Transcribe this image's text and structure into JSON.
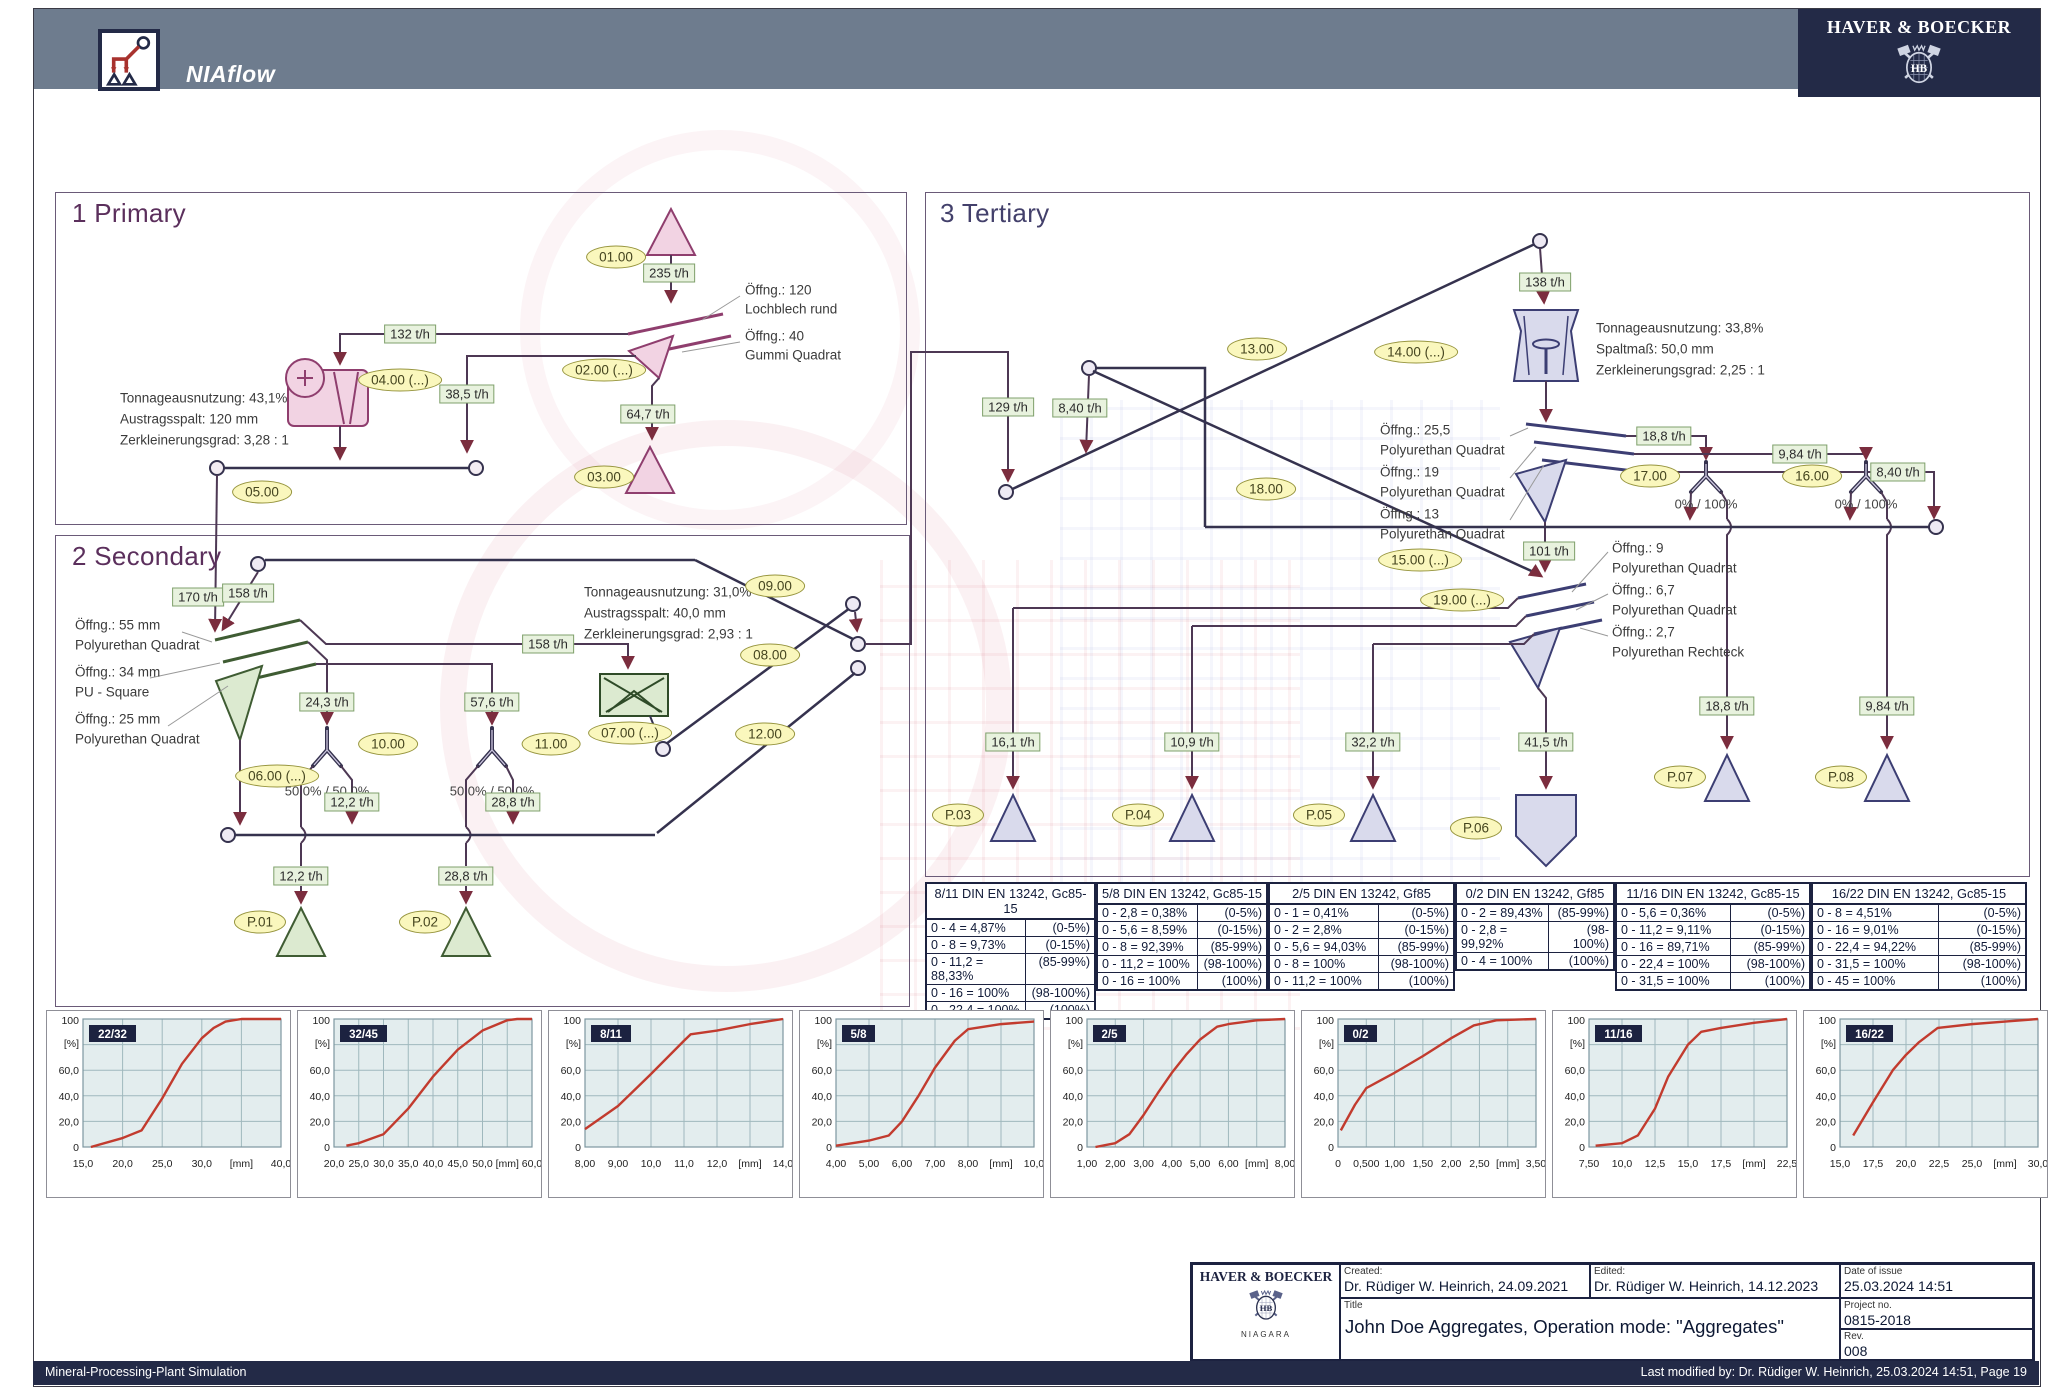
{
  "header": {
    "app_name": "NIAflow",
    "brand": "HAVER & BOECKER"
  },
  "footer": {
    "left": "Mineral-Processing-Plant Simulation",
    "right": "Last modified by: Dr. Rüdiger W. Heinrich, 25.03.2024 14:51, Page 19"
  },
  "title_block": {
    "brand": "HAVER & BOECKER",
    "brand_sub": "NIAGARA",
    "created_label": "Created:",
    "created": "Dr. Rüdiger W. Heinrich, 24.09.2021",
    "edited_label": "Edited:",
    "edited": "Dr. Rüdiger W. Heinrich, 14.12.2023",
    "date_label": "Date of issue",
    "date": "25.03.2024 14:51",
    "title_label": "Title",
    "title": "John Doe Aggregates, Operation mode: \"Aggregates\"",
    "project_label": "Project no.",
    "project": "0815-2018",
    "rev_label": "Rev.",
    "rev": "008"
  },
  "flowsheet": {
    "primary": {
      "title": "1 Primary",
      "nodes": {
        "n01": "01.00",
        "n02": "02.00 (...)",
        "n03": "03.00",
        "n04": "04.00 (...)",
        "n05": "05.00"
      },
      "flows": {
        "f235": "235 t/h",
        "f132": "132 t/h",
        "f385": "38,5 t/h",
        "f647": "64,7 t/h"
      },
      "screen_anno": [
        "Öffng.: 120",
        "Lochblech rund",
        "Öffng.: 40",
        "Gummi Quadrat"
      ],
      "crusher_anno": [
        "Tonnageausnutzung: 43,1%",
        "Austragsspalt: 120 mm",
        "Zerkleinerungsgrad: 3,28 : 1"
      ]
    },
    "secondary": {
      "title": "2 Secondary",
      "nodes": {
        "n06": "06.00 (...)",
        "n07": "07.00 (...)",
        "n08": "08.00",
        "n09": "09.00",
        "n10": "10.00",
        "n11": "11.00",
        "n12": "12.00",
        "p01": "P.01",
        "p02": "P.02"
      },
      "flows": {
        "f170": "170 t/h",
        "f158a": "158 t/h",
        "f158b": "158 t/h",
        "f243": "24,3 t/h",
        "f576": "57,6 t/h",
        "f122a": "12,2 t/h",
        "f288a": "28,8 t/h",
        "f122b": "12,2 t/h",
        "f288b": "28,8 t/h"
      },
      "screen_anno": [
        "Öffng.: 55 mm",
        "Polyurethan Quadrat",
        "Öffng.: 34 mm",
        "PU - Square",
        "Öffng.: 25 mm",
        "Polyurethan Quadrat"
      ],
      "crusher_anno": [
        "Tonnageausnutzung: 31,0%",
        "Austragsspalt: 40,0 mm",
        "Zerkleinerungsgrad: 2,93 : 1"
      ],
      "split10": "50,0% / 50,0%",
      "split11": "50,0% / 50,0%"
    },
    "tertiary": {
      "title": "3 Tertiary",
      "nodes": {
        "n13": "13.00",
        "n14": "14.00 (...)",
        "n15": "15.00 (...)",
        "n16": "16.00",
        "n17": "17.00",
        "n18": "18.00",
        "n19": "19.00 (...)",
        "p03": "P.03",
        "p04": "P.04",
        "p05": "P.05",
        "p06": "P.06",
        "p07": "P.07",
        "p08": "P.08"
      },
      "flows": {
        "f129": "129 t/h",
        "f840a": "8,40 t/h",
        "f138": "138 t/h",
        "f101": "101 t/h",
        "f188a": "18,8 t/h",
        "f984a": "9,84 t/h",
        "f840b": "8,40 t/h",
        "f161": "16,1 t/h",
        "f109": "10,9 t/h",
        "f322": "32,2 t/h",
        "f415": "41,5 t/h",
        "f188b": "18,8 t/h",
        "f984b": "9,84 t/h"
      },
      "crusher_anno": [
        "Tonnageausnutzung: 33,8%",
        "Spaltmaß: 50,0 mm",
        "Zerkleinerungsgrad: 2,25 : 1"
      ],
      "screen15_anno": [
        "Öffng.: 25,5",
        "Polyurethan Quadrat",
        "Öffng.: 19",
        "Polyurethan Quadrat",
        "Öffng.: 13",
        "Polyurethan Quadrat"
      ],
      "screen19_anno": [
        "Öffng.: 9",
        "Polyurethan Quadrat",
        "Öffng.: 6,7",
        "Polyurethan Quadrat",
        "Öffng.: 2,7",
        "Polyurethan Rechteck"
      ],
      "split17": "0% / 100%",
      "split16": "0% / 100%"
    }
  },
  "tables": [
    {
      "header": "8/11 DIN EN 13242, Gc85-15",
      "rows": [
        [
          "0 - 4 = 4,87%",
          "(0-5%)"
        ],
        [
          "0 - 8 = 9,73%",
          "(0-15%)"
        ],
        [
          "0 - 11,2 = 88,33%",
          "(85-99%)"
        ],
        [
          "0 - 16 = 100%",
          "(98-100%)"
        ],
        [
          "0 - 22,4 = 100%",
          "(100%)"
        ]
      ]
    },
    {
      "header": "5/8 DIN EN 13242, Gc85-15",
      "rows": [
        [
          "0 - 2,8 = 0,38%",
          "(0-5%)"
        ],
        [
          "0 - 5,6 = 8,59%",
          "(0-15%)"
        ],
        [
          "0 - 8 = 92,39%",
          "(85-99%)"
        ],
        [
          "0 - 11,2 = 100%",
          "(98-100%)"
        ],
        [
          "0 - 16 = 100%",
          "(100%)"
        ]
      ]
    },
    {
      "header": "2/5 DIN EN 13242, Gf85",
      "rows": [
        [
          "0 - 1 = 0,41%",
          "(0-5%)"
        ],
        [
          "0 - 2 = 2,8%",
          "(0-15%)"
        ],
        [
          "0 - 5,6 = 94,03%",
          "(85-99%)"
        ],
        [
          "0 - 8 = 100%",
          "(98-100%)"
        ],
        [
          "0 - 11,2 = 100%",
          "(100%)"
        ]
      ]
    },
    {
      "header": "0/2 DIN EN 13242, Gf85",
      "rows": [
        [
          "0 - 2 = 89,43%",
          "(85-99%)"
        ],
        [
          "0 - 2,8 = 99,92%",
          "(98-100%)"
        ],
        [
          "0 - 4 = 100%",
          "(100%)"
        ]
      ]
    },
    {
      "header": "11/16 DIN EN 13242, Gc85-15",
      "rows": [
        [
          "0 - 5,6 = 0,36%",
          "(0-5%)"
        ],
        [
          "0 - 11,2 = 9,11%",
          "(0-15%)"
        ],
        [
          "0 - 16 = 89,71%",
          "(85-99%)"
        ],
        [
          "0 - 22,4 = 100%",
          "(98-100%)"
        ],
        [
          "0 - 31,5 = 100%",
          "(100%)"
        ]
      ]
    },
    {
      "header": "16/22 DIN EN 13242, Gc85-15",
      "rows": [
        [
          "0 - 8 = 4,51%",
          "(0-5%)"
        ],
        [
          "0 - 16 = 9,01%",
          "(0-15%)"
        ],
        [
          "0 - 22,4 = 94,22%",
          "(85-99%)"
        ],
        [
          "0 - 31,5 = 100%",
          "(98-100%)"
        ],
        [
          "0 - 45 = 100%",
          "(100%)"
        ]
      ]
    }
  ],
  "chart_data": [
    {
      "type": "line",
      "name": "22/32",
      "yunit": "[%]",
      "ylim": [
        0,
        100
      ],
      "yticks": [
        "100",
        "60,0",
        "40,0",
        "20,0",
        "0"
      ],
      "xtick_pos": [
        15,
        20,
        25,
        30,
        35,
        40
      ],
      "xtick_lab": [
        "15,0",
        "20,0",
        "25,0",
        "30,0",
        "[mm]",
        "40,0"
      ],
      "points": [
        [
          16,
          0
        ],
        [
          20,
          7
        ],
        [
          22.4,
          13
        ],
        [
          25,
          38
        ],
        [
          27.5,
          65
        ],
        [
          30,
          85
        ],
        [
          31.5,
          93
        ],
        [
          33,
          98
        ],
        [
          35,
          100
        ],
        [
          40,
          100
        ]
      ]
    },
    {
      "type": "line",
      "name": "32/45",
      "yunit": "[%]",
      "ylim": [
        0,
        100
      ],
      "yticks": [
        "100",
        "60,0",
        "40,0",
        "20,0",
        "0"
      ],
      "xtick_pos": [
        20,
        25,
        30,
        35,
        40,
        45,
        50,
        55,
        60
      ],
      "xtick_lab": [
        "20,0",
        "25,0",
        "30,0",
        "35,0",
        "40,0",
        "45,0",
        "50,0",
        "[mm]",
        "60,0"
      ],
      "points": [
        [
          22.5,
          1
        ],
        [
          25,
          3
        ],
        [
          30,
          10
        ],
        [
          35,
          30
        ],
        [
          40,
          55
        ],
        [
          45,
          76
        ],
        [
          50,
          91
        ],
        [
          55,
          99
        ],
        [
          57,
          100
        ],
        [
          60,
          100
        ]
      ]
    },
    {
      "type": "line",
      "name": "8/11",
      "yunit": "[%]",
      "ylim": [
        0,
        100
      ],
      "yticks": [
        "100",
        "60,0",
        "40,0",
        "20,0",
        "0"
      ],
      "xtick_pos": [
        8,
        9,
        10,
        11,
        12,
        13,
        14
      ],
      "xtick_lab": [
        "8,00",
        "9,00",
        "10,0",
        "11,0",
        "12,0",
        "[mm]",
        "14,0"
      ],
      "points": [
        [
          8,
          14
        ],
        [
          9,
          32
        ],
        [
          10,
          57
        ],
        [
          11,
          83
        ],
        [
          11.2,
          88
        ],
        [
          12,
          91
        ],
        [
          13,
          96
        ],
        [
          14,
          100
        ]
      ]
    },
    {
      "type": "line",
      "name": "5/8",
      "yunit": "[%]",
      "ylim": [
        0,
        100
      ],
      "yticks": [
        "100",
        "60,0",
        "40,0",
        "20,0",
        "0"
      ],
      "xtick_pos": [
        4,
        5,
        6,
        7,
        8,
        9,
        10
      ],
      "xtick_lab": [
        "4,00",
        "5,00",
        "6,00",
        "7,00",
        "8,00",
        "[mm]",
        "10,0"
      ],
      "points": [
        [
          4,
          1
        ],
        [
          5,
          5
        ],
        [
          5.6,
          9
        ],
        [
          6,
          20
        ],
        [
          6.5,
          40
        ],
        [
          7,
          62
        ],
        [
          7.6,
          83
        ],
        [
          8,
          92
        ],
        [
          9,
          96
        ],
        [
          10,
          98
        ]
      ]
    },
    {
      "type": "line",
      "name": "2/5",
      "yunit": "[%]",
      "ylim": [
        0,
        100
      ],
      "yticks": [
        "100",
        "60,0",
        "40,0",
        "20,0",
        "0"
      ],
      "xtick_pos": [
        1,
        2,
        3,
        4,
        5,
        6,
        7,
        8
      ],
      "xtick_lab": [
        "1,00",
        "2,00",
        "3,00",
        "4,00",
        "5,00",
        "6,00",
        "[mm]",
        "8,00"
      ],
      "points": [
        [
          1.3,
          0
        ],
        [
          2,
          3
        ],
        [
          2.5,
          10
        ],
        [
          3,
          25
        ],
        [
          3.5,
          42
        ],
        [
          4,
          58
        ],
        [
          4.5,
          72
        ],
        [
          5,
          84
        ],
        [
          5.6,
          94
        ],
        [
          6,
          96
        ],
        [
          7,
          99
        ],
        [
          8,
          100
        ]
      ]
    },
    {
      "type": "line",
      "name": "0/2",
      "yunit": "[%]",
      "ylim": [
        0,
        100
      ],
      "yticks": [
        "100",
        "60,0",
        "40,0",
        "20,0",
        "0"
      ],
      "xtick_pos": [
        0,
        0.5,
        1,
        1.5,
        2,
        2.5,
        3,
        3.5
      ],
      "xtick_lab": [
        "0",
        "0,500",
        "1,00",
        "1,50",
        "2,00",
        "2,50",
        "[mm]",
        "3,50"
      ],
      "points": [
        [
          0.05,
          13
        ],
        [
          0.3,
          33
        ],
        [
          0.5,
          46
        ],
        [
          0.75,
          52
        ],
        [
          1,
          58
        ],
        [
          1.5,
          71
        ],
        [
          2,
          85
        ],
        [
          2.4,
          95
        ],
        [
          2.8,
          99
        ],
        [
          3.5,
          100
        ]
      ]
    },
    {
      "type": "line",
      "name": "11/16",
      "yunit": "[%]",
      "ylim": [
        0,
        100
      ],
      "yticks": [
        "100",
        "60,0",
        "40,0",
        "20,0",
        "0"
      ],
      "xtick_pos": [
        7.5,
        10,
        12.5,
        15,
        17.5,
        20,
        22.5
      ],
      "xtick_lab": [
        "7,50",
        "10,0",
        "12,5",
        "15,0",
        "17,5",
        "[mm]",
        "22,5"
      ],
      "points": [
        [
          8,
          1
        ],
        [
          10,
          3
        ],
        [
          11.2,
          9
        ],
        [
          12.5,
          30
        ],
        [
          13.5,
          55
        ],
        [
          15,
          80
        ],
        [
          16,
          90
        ],
        [
          17.5,
          93
        ],
        [
          20,
          97
        ],
        [
          22.5,
          100
        ]
      ]
    },
    {
      "type": "line",
      "name": "16/22",
      "yunit": "[%]",
      "ylim": [
        0,
        100
      ],
      "yticks": [
        "100",
        "60,0",
        "40,0",
        "20,0",
        "0"
      ],
      "xtick_pos": [
        15,
        17.5,
        20,
        22.5,
        25,
        27.5,
        30
      ],
      "xtick_lab": [
        "15,0",
        "17,5",
        "20,0",
        "22,5",
        "25,0",
        "[mm]",
        "30,0"
      ],
      "points": [
        [
          16,
          9
        ],
        [
          17.5,
          35
        ],
        [
          19,
          60
        ],
        [
          20,
          72
        ],
        [
          21,
          82
        ],
        [
          22.4,
          93
        ],
        [
          25,
          96
        ],
        [
          27.5,
          98
        ],
        [
          30,
          100
        ]
      ]
    }
  ],
  "colors": {
    "header_bg": "#6E7C8E",
    "navy": "#232A47",
    "node_fill": "#FAF7BD",
    "flow_fill": "#E8F2DE",
    "line": "#4D3854",
    "conveyor": "#35324E",
    "arrow": "#7B2D3E",
    "primary_fill": "#F2D3E3",
    "primary_stroke": "#8F3E6E",
    "secondary_fill": "#DCEAD0",
    "secondary_stroke": "#3F5C33",
    "tertiary_fill": "#D9DAEC",
    "tertiary_stroke": "#3C3E73",
    "curve": "#C23B2E",
    "chart_bg": "#E3EDEE"
  }
}
